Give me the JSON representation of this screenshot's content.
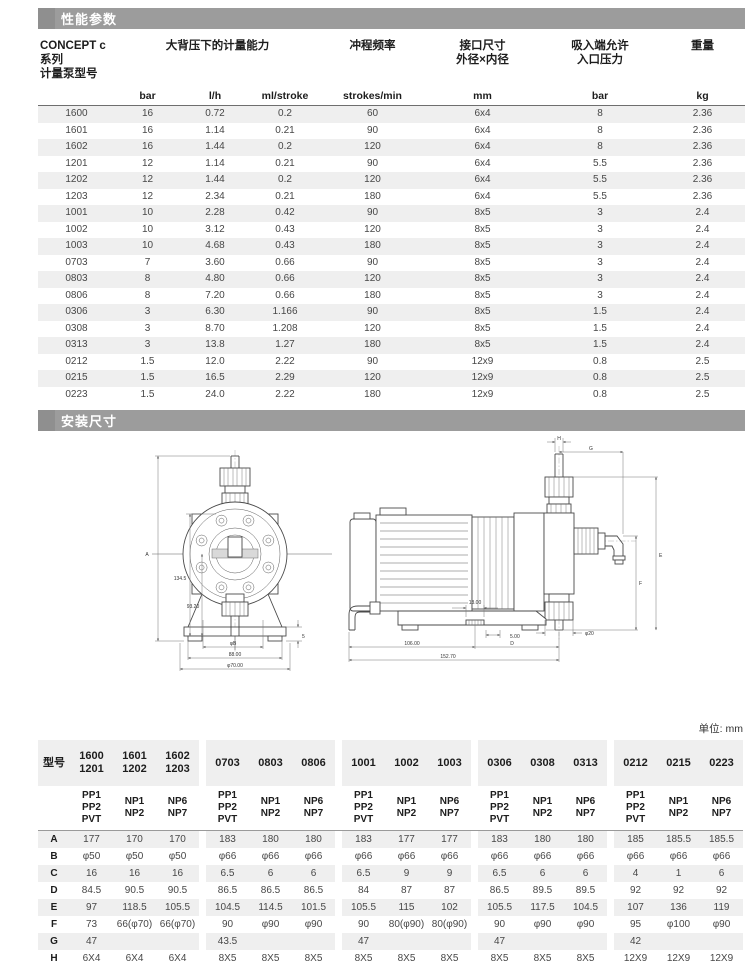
{
  "page": {
    "unit_note": "单位: mm"
  },
  "colors": {
    "title_bar": "#9c9c9c",
    "title_bar_accent": "#8f8f8f",
    "row_stripe": "#efefef",
    "table_border": "#6e6e6e"
  },
  "sections": {
    "performance": {
      "title": "性能参数"
    },
    "dimensions": {
      "title": "安装尺寸"
    }
  },
  "perf_table": {
    "headers": {
      "model": "CONCEPT c系列\n计量泵型号",
      "capacity": "大背压下的计量能力",
      "stroke_frequency": "冲程频率",
      "port": "接口尺寸\n外径×内径",
      "suction": "吸入端允许\n入口压力",
      "weight": "重量"
    },
    "units": {
      "pressure": "bar",
      "flow": "l/h",
      "per_stroke": "ml/stroke",
      "frequency": "strokes/min",
      "port": "mm",
      "suction": "bar",
      "weight": "kg"
    },
    "rows": [
      [
        "1600",
        "16",
        "0.72",
        "0.2",
        "60",
        "6x4",
        "8",
        "2.36"
      ],
      [
        "1601",
        "16",
        "1.14",
        "0.21",
        "90",
        "6x4",
        "8",
        "2.36"
      ],
      [
        "1602",
        "16",
        "1.44",
        "0.2",
        "120",
        "6x4",
        "8",
        "2.36"
      ],
      [
        "1201",
        "12",
        "1.14",
        "0.21",
        "90",
        "6x4",
        "5.5",
        "2.36"
      ],
      [
        "1202",
        "12",
        "1.44",
        "0.2",
        "120",
        "6x4",
        "5.5",
        "2.36"
      ],
      [
        "1203",
        "12",
        "2.34",
        "0.21",
        "180",
        "6x4",
        "5.5",
        "2.36"
      ],
      [
        "1001",
        "10",
        "2.28",
        "0.42",
        "90",
        "8x5",
        "3",
        "2.4"
      ],
      [
        "1002",
        "10",
        "3.12",
        "0.43",
        "120",
        "8x5",
        "3",
        "2.4"
      ],
      [
        "1003",
        "10",
        "4.68",
        "0.43",
        "180",
        "8x5",
        "3",
        "2.4"
      ],
      [
        "0703",
        "7",
        "3.60",
        "0.66",
        "90",
        "8x5",
        "3",
        "2.4"
      ],
      [
        "0803",
        "8",
        "4.80",
        "0.66",
        "120",
        "8x5",
        "3",
        "2.4"
      ],
      [
        "0806",
        "8",
        "7.20",
        "0.66",
        "180",
        "8x5",
        "3",
        "2.4"
      ],
      [
        "0306",
        "3",
        "6.30",
        "1.166",
        "90",
        "8x5",
        "1.5",
        "2.4"
      ],
      [
        "0308",
        "3",
        "8.70",
        "1.208",
        "120",
        "8x5",
        "1.5",
        "2.4"
      ],
      [
        "0313",
        "3",
        "13.8",
        "1.27",
        "180",
        "8x5",
        "1.5",
        "2.4"
      ],
      [
        "0212",
        "1.5",
        "12.0",
        "2.22",
        "90",
        "12x9",
        "0.8",
        "2.5"
      ],
      [
        "0215",
        "1.5",
        "16.5",
        "2.29",
        "120",
        "12x9",
        "0.8",
        "2.5"
      ],
      [
        "0223",
        "1.5",
        "24.0",
        "2.22",
        "180",
        "12x9",
        "0.8",
        "2.5"
      ]
    ]
  },
  "drawings": {
    "front_view": {
      "labels": {
        "overall_height": "A",
        "height_1": "134.5",
        "height_2": "93.20",
        "dia_b": "φB",
        "width": "88.00",
        "dia_outer": "φ70.00",
        "foot_height": "5"
      }
    },
    "side_view": {
      "labels": {
        "h": "H",
        "g": "G",
        "e": "E",
        "f": "F",
        "d": "D",
        "slot": "13.00",
        "offset": "5.00",
        "length_1": "106.00",
        "length_total": "152.70",
        "dia_port": "φ20"
      }
    }
  },
  "dim_table": {
    "row_label_header": "型号",
    "groups": [
      {
        "models": [
          "1600\n1201",
          "1601\n1202",
          "1602\n1203"
        ],
        "materials": [
          "PP1\nPP2\nPVT",
          "NP1\nNP2",
          "NP6\nNP7"
        ]
      },
      {
        "models": [
          "0703",
          "0803",
          "0806"
        ],
        "materials": [
          "PP1\nPP2\nPVT",
          "NP1\nNP2",
          "NP6\nNP7"
        ]
      },
      {
        "models": [
          "1001",
          "1002",
          "1003"
        ],
        "materials": [
          "PP1\nPP2\nPVT",
          "NP1\nNP2",
          "NP6\nNP7"
        ]
      },
      {
        "models": [
          "0306",
          "0308",
          "0313"
        ],
        "materials": [
          "PP1\nPP2\nPVT",
          "NP1\nNP2",
          "NP6\nNP7"
        ]
      },
      {
        "models": [
          "0212",
          "0215",
          "0223"
        ],
        "materials": [
          "PP1\nPP2\nPVT",
          "NP1\nNP2",
          "NP6\nNP7"
        ]
      }
    ],
    "rows": [
      {
        "label": "A",
        "groups": [
          [
            "177",
            "170",
            "170"
          ],
          [
            "183",
            "180",
            "180"
          ],
          [
            "183",
            "177",
            "177"
          ],
          [
            "183",
            "180",
            "180"
          ],
          [
            "185",
            "185.5",
            "185.5"
          ]
        ]
      },
      {
        "label": "B",
        "groups": [
          [
            "φ50",
            "φ50",
            "φ50"
          ],
          [
            "φ66",
            "φ66",
            "φ66"
          ],
          [
            "φ66",
            "φ66",
            "φ66"
          ],
          [
            "φ66",
            "φ66",
            "φ66"
          ],
          [
            "φ66",
            "φ66",
            "φ66"
          ]
        ]
      },
      {
        "label": "C",
        "groups": [
          [
            "16",
            "16",
            "16"
          ],
          [
            "6.5",
            "6",
            "6"
          ],
          [
            "6.5",
            "9",
            "9"
          ],
          [
            "6.5",
            "6",
            "6"
          ],
          [
            "4",
            "1",
            "6"
          ]
        ]
      },
      {
        "label": "D",
        "groups": [
          [
            "84.5",
            "90.5",
            "90.5"
          ],
          [
            "86.5",
            "86.5",
            "86.5"
          ],
          [
            "84",
            "87",
            "87"
          ],
          [
            "86.5",
            "89.5",
            "89.5"
          ],
          [
            "92",
            "92",
            "92"
          ]
        ]
      },
      {
        "label": "E",
        "groups": [
          [
            "97",
            "118.5",
            "105.5"
          ],
          [
            "104.5",
            "114.5",
            "101.5"
          ],
          [
            "105.5",
            "115",
            "102"
          ],
          [
            "105.5",
            "117.5",
            "104.5"
          ],
          [
            "107",
            "136",
            "119"
          ]
        ]
      },
      {
        "label": "F",
        "groups": [
          [
            "73",
            "66(φ70)",
            "66(φ70)"
          ],
          [
            "90",
            "φ90",
            "φ90"
          ],
          [
            "90",
            "80(φ90)",
            "80(φ90)"
          ],
          [
            "90",
            "φ90",
            "φ90"
          ],
          [
            "95",
            "φ100",
            "φ90"
          ]
        ]
      },
      {
        "label": "G",
        "groups": [
          [
            "47",
            "",
            ""
          ],
          [
            "43.5",
            "",
            ""
          ],
          [
            "47",
            "",
            ""
          ],
          [
            "47",
            "",
            ""
          ],
          [
            "42",
            "",
            ""
          ]
        ]
      },
      {
        "label": "H",
        "groups": [
          [
            "6X4",
            "6X4",
            "6X4"
          ],
          [
            "8X5",
            "8X5",
            "8X5"
          ],
          [
            "8X5",
            "8X5",
            "8X5"
          ],
          [
            "8X5",
            "8X5",
            "8X5"
          ],
          [
            "12X9",
            "12X9",
            "12X9"
          ]
        ]
      }
    ]
  }
}
